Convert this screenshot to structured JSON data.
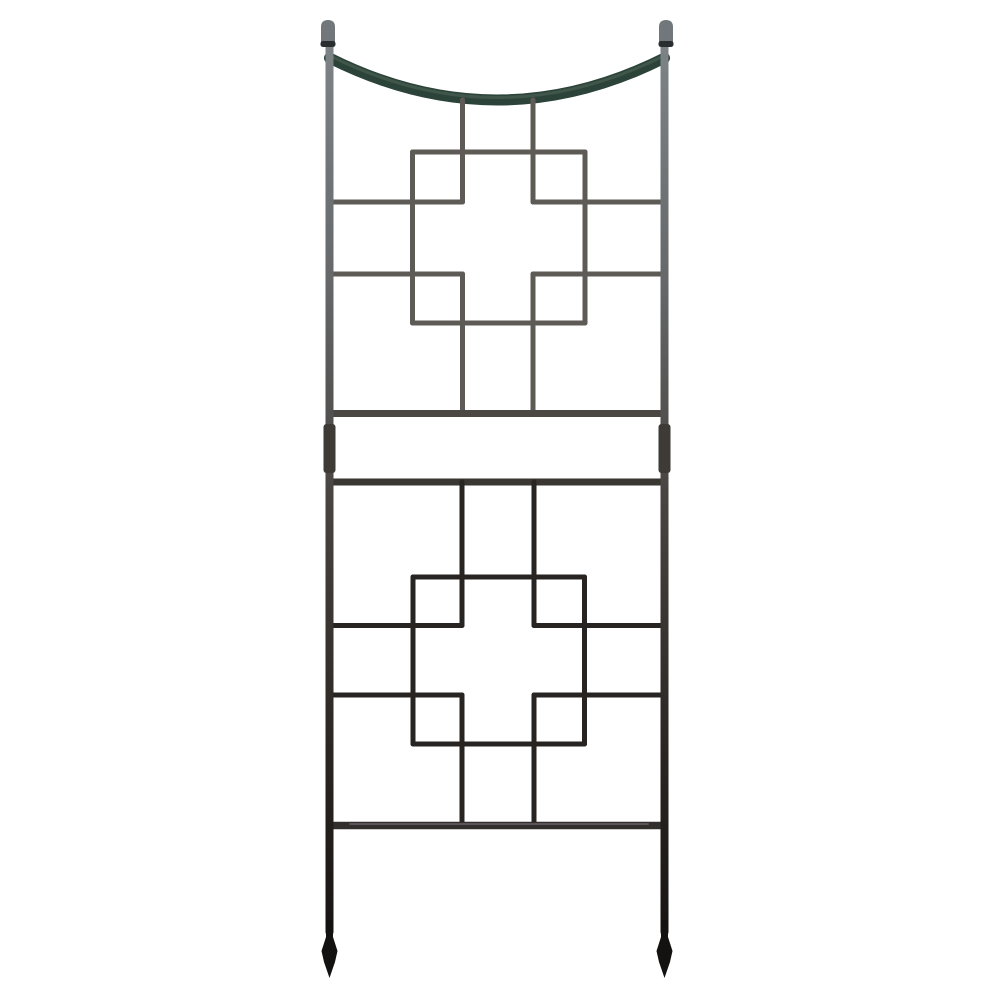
{
  "photo": {
    "background": "#ffffff",
    "subject": "Iron square-on-squares garden trellis with curved top swag, ball finials and spear-point feet"
  },
  "trellis": {
    "canvas": {
      "width": 1000,
      "height": 999
    },
    "colors": {
      "post_top": "#7e8486",
      "post_upper_mid": "#66686a",
      "post_mid": "#46423e",
      "post_low": "#2a2622",
      "post_bottom": "#121010",
      "arc_main": "#2c4339",
      "arc_highlight": "#53695c",
      "wire_upper": "#5e5b56",
      "wire_lower": "#282421",
      "rail_upper": "#4b4743",
      "rail_mid": "#3a3632",
      "rail_bottom": "#322e2b",
      "rail_bottom_sheen": "#5a545a",
      "coupler": "#3e3a36",
      "finial_cap": "#71777a",
      "finial_collar": "#2b2e2f",
      "foot": "#141210"
    },
    "posts": {
      "left_x": 329.5,
      "right_x": 664.5,
      "top_y": 44,
      "bottom_y": 932,
      "width": 8
    },
    "finials": {
      "cap_width": 14,
      "cap_top_y": 20,
      "cap_height": 23,
      "collar_y": 41,
      "collar_height": 6,
      "collar_width": 15
    },
    "arc": {
      "y_end": 58,
      "control_y": 142,
      "stroke": 11
    },
    "couplers": {
      "y": 424,
      "height": 49,
      "width": 12,
      "radius": 3
    },
    "feet": {
      "neck_y": 920,
      "shoulder_y": 937,
      "flare_y": 951,
      "taper_y": 962,
      "tip_y": 978,
      "neck_half": 3.5,
      "flare_half": 8,
      "taper_half": 5.5
    },
    "segments": [
      {
        "x1": 462.5,
        "y1": 100,
        "x2": 462.5,
        "y2": 202,
        "w": 5,
        "c": "wire_upper"
      },
      {
        "x1": 533,
        "y1": 100,
        "x2": 533,
        "y2": 202,
        "w": 5,
        "c": "wire_upper"
      },
      {
        "x1": 412.5,
        "y1": 152,
        "x2": 585,
        "y2": 152,
        "w": 5,
        "c": "wire_upper"
      },
      {
        "x1": 412.5,
        "y1": 152,
        "x2": 412.5,
        "y2": 323,
        "w": 5,
        "c": "wire_upper"
      },
      {
        "x1": 585,
        "y1": 152,
        "x2": 585,
        "y2": 323,
        "w": 5,
        "c": "wire_upper"
      },
      {
        "x1": 412.5,
        "y1": 323,
        "x2": 585,
        "y2": 323,
        "w": 5,
        "c": "wire_upper"
      },
      {
        "x1": 329.5,
        "y1": 202,
        "x2": 462.5,
        "y2": 202,
        "w": 5,
        "c": "wire_upper"
      },
      {
        "x1": 533,
        "y1": 202,
        "x2": 664.5,
        "y2": 202,
        "w": 5,
        "c": "wire_upper"
      },
      {
        "x1": 329.5,
        "y1": 274,
        "x2": 462.5,
        "y2": 274,
        "w": 5,
        "c": "wire_upper"
      },
      {
        "x1": 533,
        "y1": 274,
        "x2": 664.5,
        "y2": 274,
        "w": 5,
        "c": "wire_upper"
      },
      {
        "x1": 462.5,
        "y1": 274,
        "x2": 462.5,
        "y2": 413,
        "w": 5,
        "c": "wire_upper"
      },
      {
        "x1": 533,
        "y1": 274,
        "x2": 533,
        "y2": 413,
        "w": 5,
        "c": "wire_upper"
      },
      {
        "x1": 329.5,
        "y1": 413.5,
        "x2": 664.5,
        "y2": 413.5,
        "w": 7,
        "c": "rail_upper"
      },
      {
        "x1": 329.5,
        "y1": 482,
        "x2": 664.5,
        "y2": 482,
        "w": 7,
        "c": "rail_mid"
      },
      {
        "x1": 462,
        "y1": 482,
        "x2": 462,
        "y2": 625.5,
        "w": 5,
        "c": "wire_lower"
      },
      {
        "x1": 534,
        "y1": 482,
        "x2": 534,
        "y2": 625.5,
        "w": 5,
        "c": "wire_lower"
      },
      {
        "x1": 413,
        "y1": 577,
        "x2": 584.5,
        "y2": 577,
        "w": 5,
        "c": "wire_lower"
      },
      {
        "x1": 413,
        "y1": 577,
        "x2": 413,
        "y2": 744,
        "w": 5,
        "c": "wire_lower"
      },
      {
        "x1": 584.5,
        "y1": 577,
        "x2": 584.5,
        "y2": 744,
        "w": 5,
        "c": "wire_lower"
      },
      {
        "x1": 413,
        "y1": 744,
        "x2": 584.5,
        "y2": 744,
        "w": 5,
        "c": "wire_lower"
      },
      {
        "x1": 329.5,
        "y1": 625.5,
        "x2": 462,
        "y2": 625.5,
        "w": 5,
        "c": "wire_lower"
      },
      {
        "x1": 534,
        "y1": 625.5,
        "x2": 664.5,
        "y2": 625.5,
        "w": 5,
        "c": "wire_lower"
      },
      {
        "x1": 329.5,
        "y1": 695,
        "x2": 462,
        "y2": 695,
        "w": 5,
        "c": "wire_lower"
      },
      {
        "x1": 534,
        "y1": 695,
        "x2": 664.5,
        "y2": 695,
        "w": 5,
        "c": "wire_lower"
      },
      {
        "x1": 462,
        "y1": 695,
        "x2": 462,
        "y2": 825,
        "w": 5,
        "c": "wire_lower"
      },
      {
        "x1": 534,
        "y1": 695,
        "x2": 534,
        "y2": 825,
        "w": 5,
        "c": "wire_lower"
      },
      {
        "x1": 329.5,
        "y1": 825.5,
        "x2": 664.5,
        "y2": 825.5,
        "w": 7.5,
        "c": "rail_bottom"
      },
      {
        "x1": 350,
        "y1": 824,
        "x2": 648,
        "y2": 824,
        "w": 2,
        "c": "rail_bottom_sheen"
      }
    ]
  }
}
